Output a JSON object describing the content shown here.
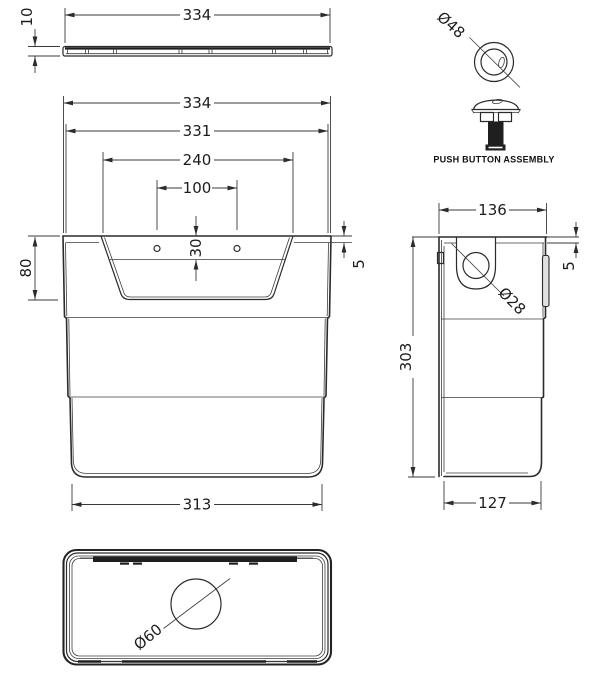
{
  "drawing": {
    "background_color": "#ffffff",
    "line_color": "#2b2b2b",
    "lid_profile": {
      "width": "334",
      "thickness": "10"
    },
    "front_view": {
      "overall_width": "334",
      "inner_width": "331",
      "recess_width": "240",
      "hole_centres": "100",
      "recess_step": "30",
      "recess_depth": "80",
      "rim_lip": "5",
      "base_width": "313"
    },
    "side_view": {
      "top_depth": "136",
      "rim_lip": "5",
      "height": "303",
      "base_depth": "127",
      "inlet_diameter": "Ø28"
    },
    "push_button_detail": {
      "diameter": "Ø48",
      "caption": "PUSH BUTTON ASSEMBLY"
    },
    "plan_view": {
      "flush_valve_diameter": "Ø60"
    }
  }
}
